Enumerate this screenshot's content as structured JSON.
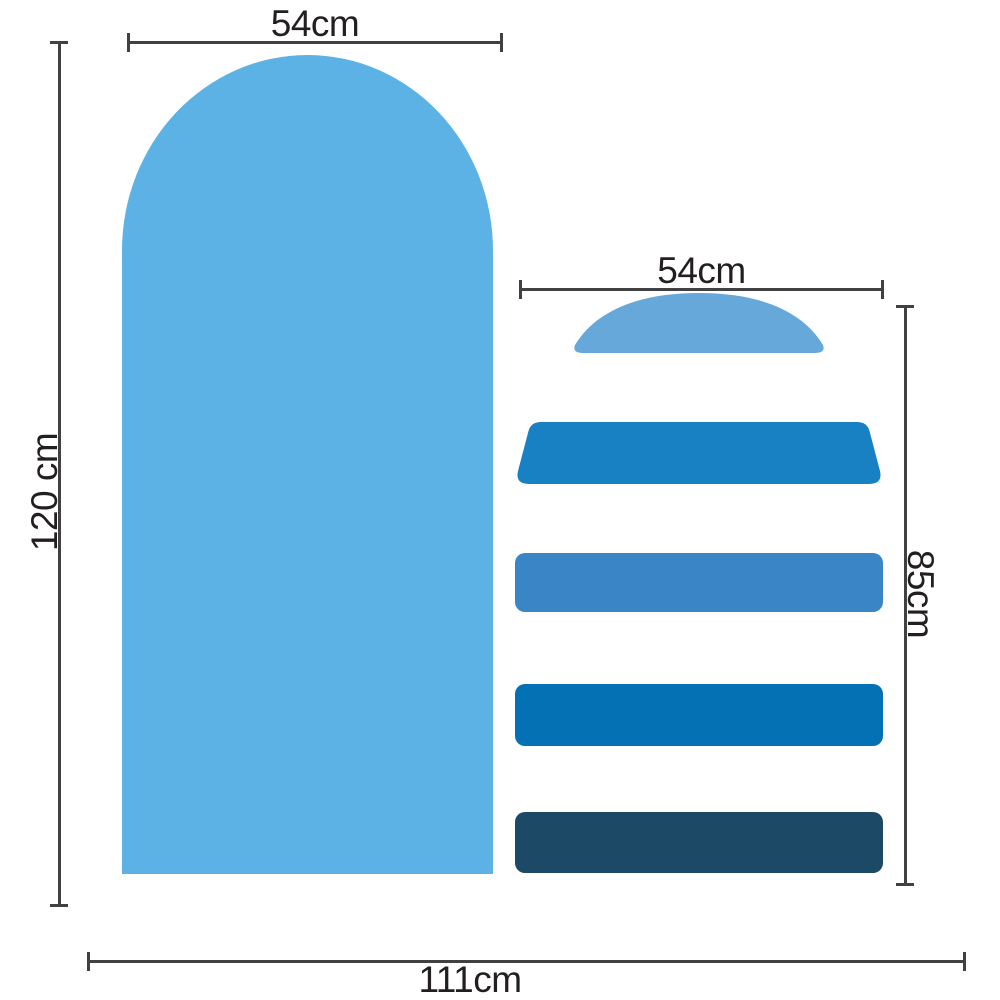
{
  "colors": {
    "background": "#ffffff",
    "dimension_line": "#414042",
    "label_text": "#231f20",
    "arch": "#5cb2e4",
    "dome": "#67a8da",
    "bar_top": "#1781c4",
    "bar_second": "#3a85c5",
    "bar_third": "#0571b5",
    "bar_bottom": "#1c4965"
  },
  "labels": {
    "arch_width": "54cm",
    "arch_height": "120 cm",
    "stack_width": "54cm",
    "stack_height": "85cm",
    "total_width": "111cm"
  }
}
